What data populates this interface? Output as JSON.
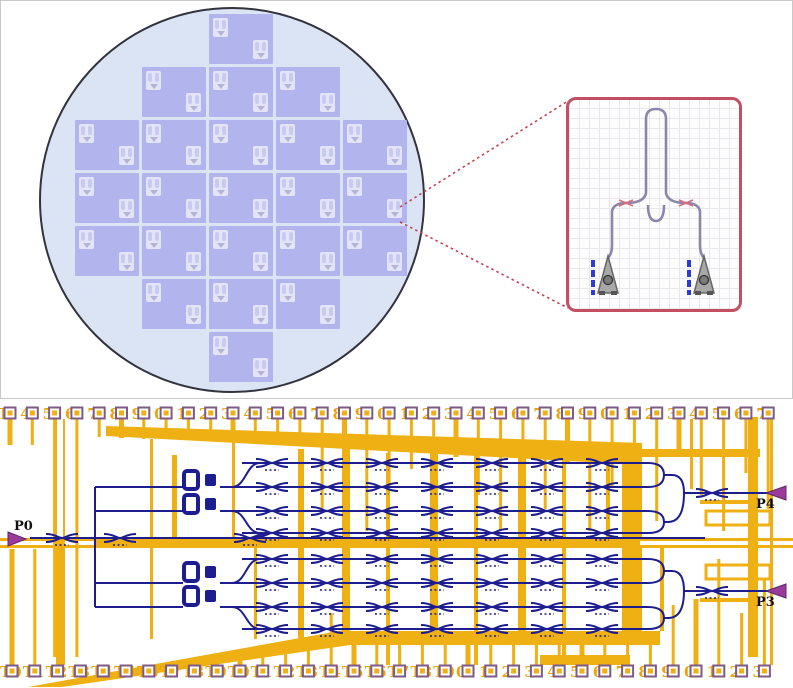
{
  "figure": {
    "description": "Wafer die map with device zoom callout and photonic chip routing layout"
  },
  "colors": {
    "metal_trace": "#eeb012",
    "waveguide": "#1d1d8f",
    "pad_border": "#7d5b86",
    "pad_label": "#eaa50c",
    "wafer_fill": "#dbe4f4",
    "wafer_outline": "#33333d",
    "die_fill": "#b2b5ed",
    "die_glyph_fill": "#e4e4f8",
    "callout_border": "#c44f63",
    "callout_grid": "#e9e9ed",
    "zoom_dotted_line": "#c3404f",
    "device_waveguide": "#8d86ac",
    "grating_coupler_fill": "#a8a8a8",
    "grating_marks_blue": "#2b3bd6",
    "coupler_mark_pink": "#d66a7d",
    "port_arrow": "#9a3a9a",
    "port_label": "#111111"
  },
  "top_panel": {
    "wafer": {
      "die_rows": [
        1,
        3,
        5,
        5,
        5,
        3,
        1
      ],
      "glyphs_per_die": 2
    },
    "callout": {
      "device": "loop-mirror with two grating couplers",
      "coupler_marks": 2,
      "grating_couplers": 2
    }
  },
  "bottom_panel": {
    "top_pads": {
      "labels": [
        "T",
        "4",
        "5",
        "6",
        "7",
        "8",
        "9",
        "0",
        "1",
        "2",
        "3",
        "4",
        "5",
        "6",
        "7",
        "8",
        "9",
        "0",
        "1",
        "2",
        "3",
        "4",
        "5",
        "6",
        "7",
        "8",
        "9",
        "0",
        "1",
        "2",
        "3",
        "4",
        "5",
        "6",
        "7"
      ]
    },
    "bottom_pads": {
      "labels": [
        "T0",
        "T1",
        "T2",
        "T3",
        "T4",
        "T5",
        "T6",
        "T7",
        "T8",
        "T9",
        "T0",
        "T1",
        "T2",
        "T3",
        "T4",
        "T5",
        "T6",
        "T7",
        "T8",
        "T9",
        "0",
        "1",
        "2",
        "3",
        "4",
        "5",
        "6",
        "7",
        "8",
        "9",
        "0",
        "1",
        "2",
        "3"
      ]
    },
    "ports": [
      {
        "label": "P0",
        "side": "left"
      },
      {
        "label": "P4",
        "side": "right"
      },
      {
        "label": "P3",
        "side": "right"
      }
    ]
  }
}
